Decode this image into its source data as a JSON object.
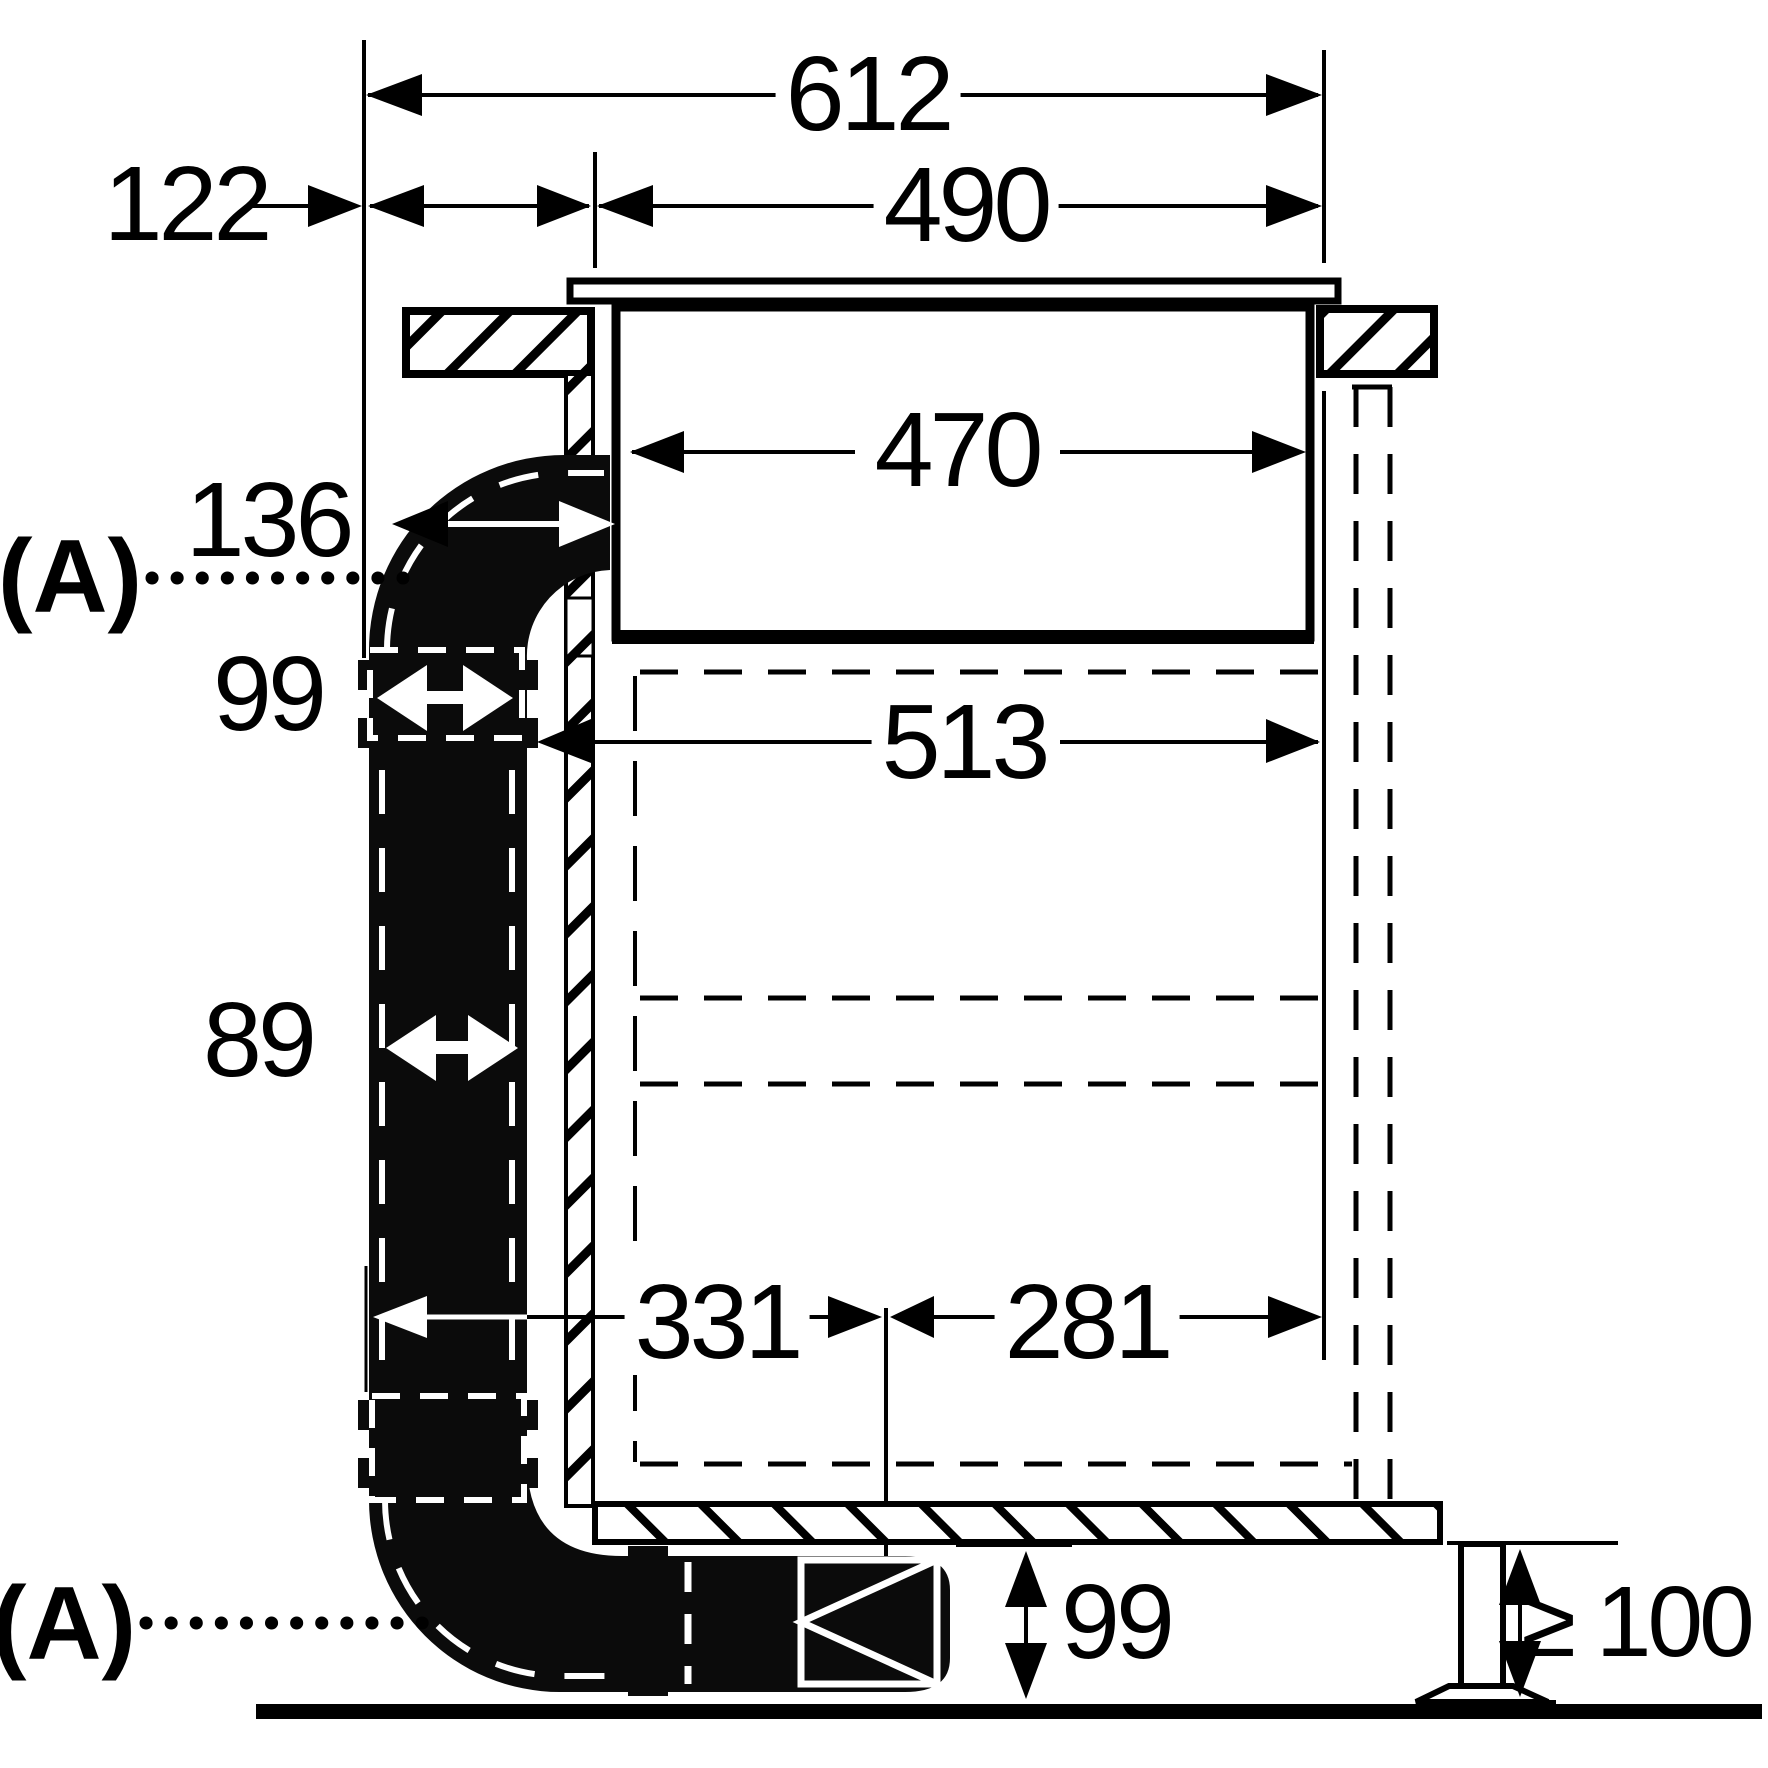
{
  "diagram": {
    "labels": {
      "overall_width": "612",
      "hob_top_width": "490",
      "rear_offset": "122",
      "hob_body_width": "470",
      "duct_to_body": "136",
      "duct_connector_width": "99",
      "cabinet_inner_width": "513",
      "duct_depth": "89",
      "bottom_span_left": "331",
      "bottom_span_right": "281",
      "plinth_duct_height": "99",
      "plinth_min_clearance": "≥ 100",
      "section_marker_top": "(A)",
      "section_marker_bottom": "(A)"
    },
    "colors": {
      "ink": "#000000",
      "duct_fill": "#0b0b0b",
      "paper": "#ffffff"
    }
  }
}
